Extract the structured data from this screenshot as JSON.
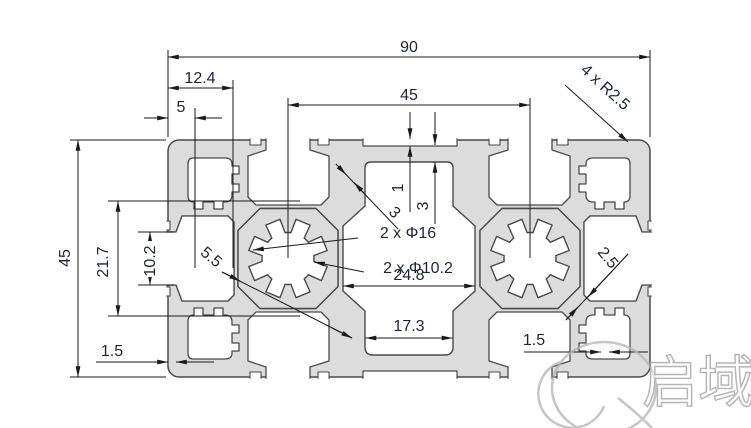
{
  "drawing": {
    "type": "aluminum-extrusion-profile-cross-section",
    "dims": {
      "overall_width": "90",
      "corner_block_width": "12.4",
      "lip_offset": "5",
      "bore_center_distance": "45",
      "corner_radius": "4 x R2.5",
      "overall_height": "45",
      "side_slot_span": "21.7",
      "side_slot_opening": "10.2",
      "web_thickness": "5.5",
      "recess_depth": "1",
      "top_wall_thickness": "3",
      "cavity_wall_thickness": "3",
      "bore_outer": "2 x Φ16",
      "bore_inner": "2 x Φ10.2",
      "cavity_width": "24.8",
      "cavity_bottom_width": "17.3",
      "wall_bottom_left": "1.5",
      "wall_bottom_right": "1.5",
      "diagonal_wall": "2.5"
    },
    "watermark": {
      "char1": "启",
      "char2": "域"
    },
    "colors": {
      "profile_fill": "#dcdcdc",
      "edge": "#4a4a4a",
      "dimension_line": "#1a1a1a",
      "dimension_text": "#1c2436",
      "watermark": "#9f9f9f",
      "background": "#ffffff"
    }
  }
}
